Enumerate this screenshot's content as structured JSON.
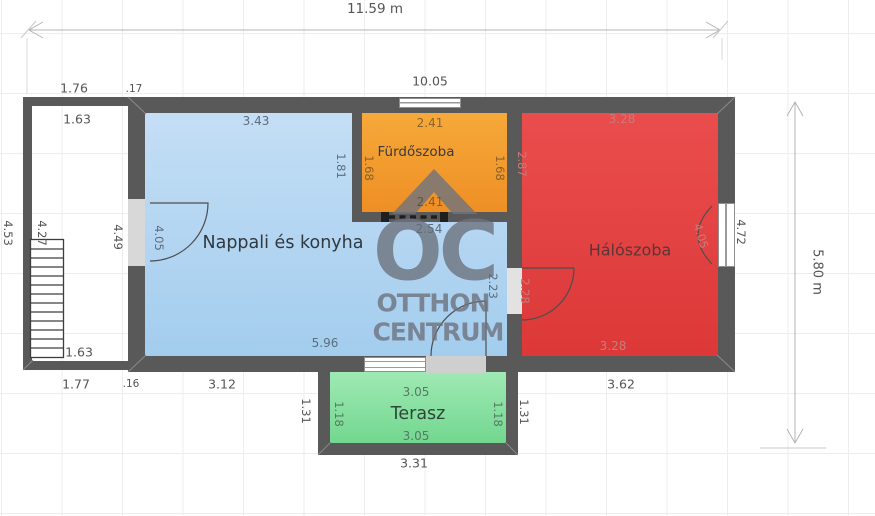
{
  "plan": {
    "overall_dims": {
      "total_width": "11.59 m",
      "total_height": "5.80 m",
      "inner_width": "10.05"
    },
    "watermark": {
      "monogram": "OC",
      "line1": "OTTHON",
      "line2": "CENTRUM"
    },
    "rooms": {
      "living": {
        "name": "Nappali és konyha",
        "dims": {
          "top": "3.43",
          "left_door": "4.05",
          "right_upper": "1.81",
          "below_bath": "2.54",
          "right_lower": "2.23",
          "bottom": "5.96",
          "outside_bottom": "3.12"
        }
      },
      "bathroom": {
        "name": "Fürdőszoba",
        "dims": {
          "top": "2.41",
          "bottom": "2.41",
          "left": "1.68",
          "right": "1.68"
        }
      },
      "bedroom": {
        "name": "Hálószoba",
        "dims": {
          "top": "3.28",
          "bottom": "3.28",
          "left_upper": "2.87",
          "door_left": "2.28",
          "door_right": "4.05",
          "outside_right": "4.72",
          "outside_bottom": "3.62"
        }
      },
      "terrace": {
        "name": "Terasz",
        "dims": {
          "top": "3.05",
          "bottom": "3.05",
          "left": "1.18",
          "right": "1.18",
          "outside_left": "1.31",
          "outside_right": "1.31",
          "outside_bottom": "3.31"
        }
      },
      "porch": {
        "dims": {
          "top_outside": "1.76",
          "top_wall_thickness": ".17",
          "top_inside": "1.63",
          "left_outside": "4.53",
          "stairs": "4.27",
          "house_left_wall": "4.49",
          "bottom_inside": "1.63",
          "bottom_outside": "1.77",
          "bottom_wall_thickness": ".16"
        }
      }
    },
    "colors": {
      "wall": "#595959",
      "living": "#b0d4f1",
      "bathroom": "#f19d2f",
      "bedroom": "#e24242",
      "terrace": "#8ce0a4",
      "watermark": "#6e737e",
      "dimension_text": "#555555"
    }
  }
}
